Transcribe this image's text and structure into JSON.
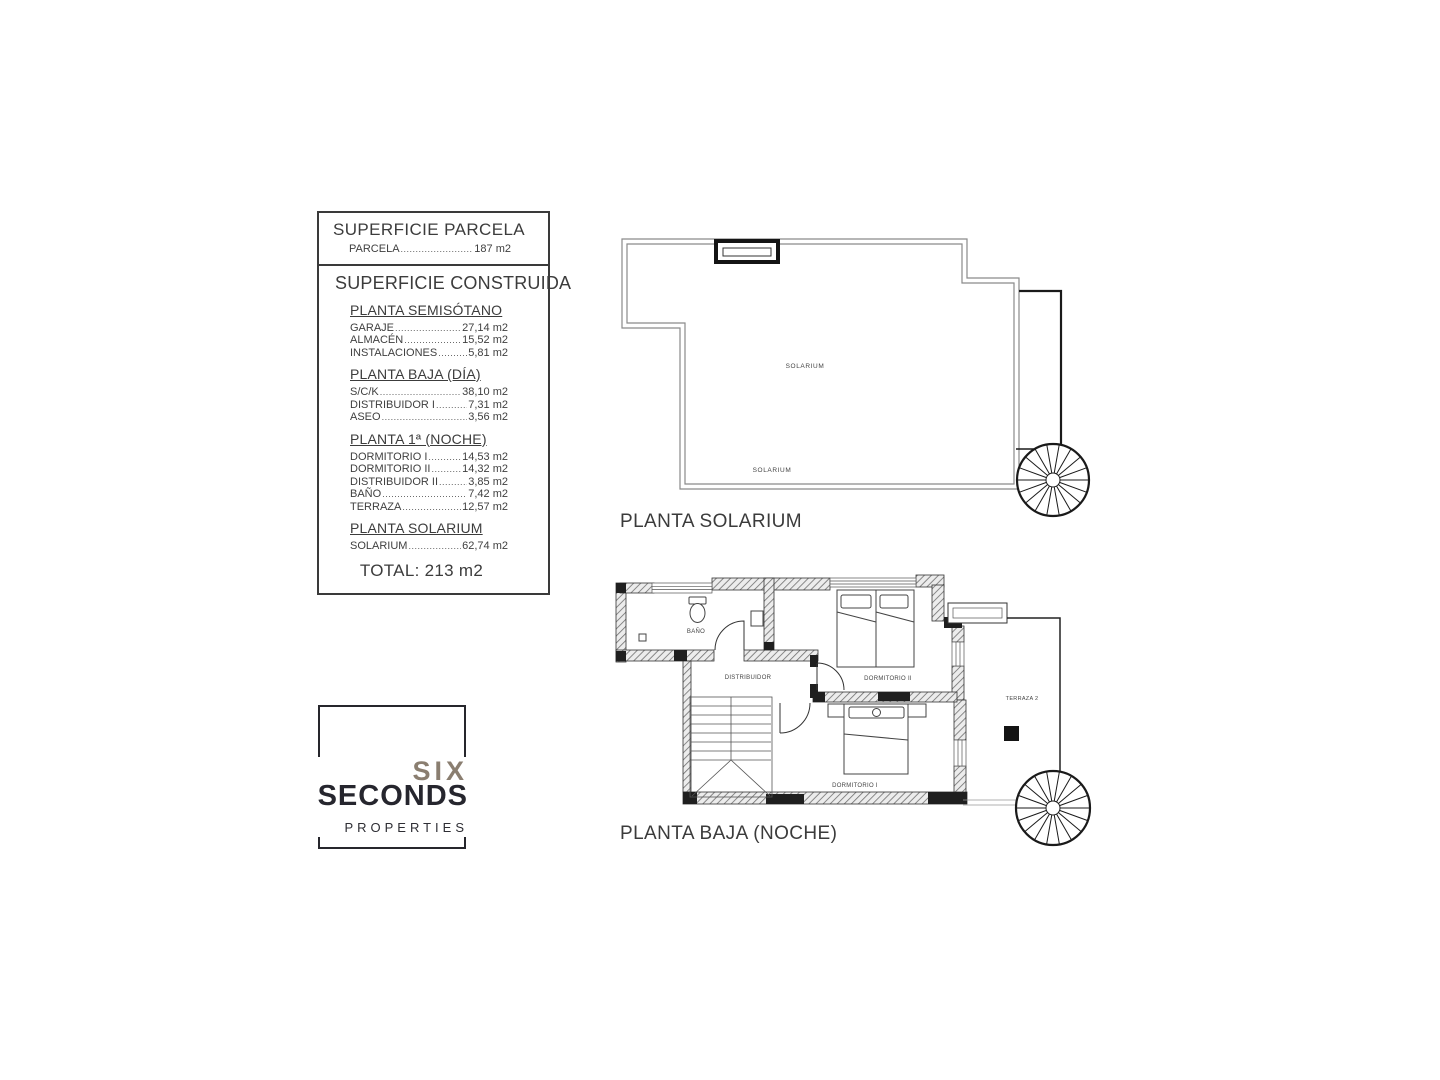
{
  "area_table": {
    "parcel_section": {
      "title": "SUPERFICIE PARCELA",
      "rows": [
        {
          "label": "PARCELA",
          "value": "187 m2"
        }
      ]
    },
    "built_section": {
      "title": "SUPERFICIE CONSTRUIDA",
      "groups": [
        {
          "title": "PLANTA SEMISÓTANO",
          "rows": [
            {
              "label": "GARAJE",
              "value": "27,14 m2"
            },
            {
              "label": "ALMACÉN",
              "value": "15,52 m2"
            },
            {
              "label": "INSTALACIONES",
              "value": "5,81 m2"
            }
          ]
        },
        {
          "title": "PLANTA BAJA (DÍA)",
          "rows": [
            {
              "label": "S/C/K",
              "value": "38,10 m2"
            },
            {
              "label": "DISTRIBUIDOR I",
              "value": "7,31 m2"
            },
            {
              "label": "ASEO",
              "value": "3,56 m2"
            }
          ]
        },
        {
          "title": "PLANTA 1ª (NOCHE)",
          "rows": [
            {
              "label": "DORMITORIO I",
              "value": "14,53 m2"
            },
            {
              "label": "DORMITORIO II",
              "value": "14,32 m2"
            },
            {
              "label": "DISTRIBUIDOR II",
              "value": "3,85 m2"
            },
            {
              "label": "BAÑO",
              "value": "7,42 m2"
            },
            {
              "label": "TERRAZA",
              "value": "12,57 m2"
            }
          ]
        },
        {
          "title": "PLANTA SOLARIUM",
          "rows": [
            {
              "label": "SOLARIUM",
              "value": "62,74 m2"
            }
          ]
        }
      ],
      "total": "TOTAL: 213 m2"
    }
  },
  "plans": {
    "solarium": {
      "title": "PLANTA SOLARIUM",
      "labels": {
        "center": "SOLARIUM",
        "bottom": "SOLARIUM"
      }
    },
    "night": {
      "title": "PLANTA BAJA (NOCHE)",
      "labels": {
        "bath": "BAÑO",
        "hall": "DISTRIBUIDOR",
        "bedroom2": "DORMITORIO II",
        "bedroom1": "DORMITORIO I",
        "terrace": "TERRAZA 2"
      }
    }
  },
  "logo": {
    "line1": "SIX",
    "line2": "SECONDS",
    "line3": "PROPERTIES",
    "colors": {
      "six": "#8a7e70",
      "seconds": "#26262e",
      "properties": "#2e2e34"
    }
  }
}
